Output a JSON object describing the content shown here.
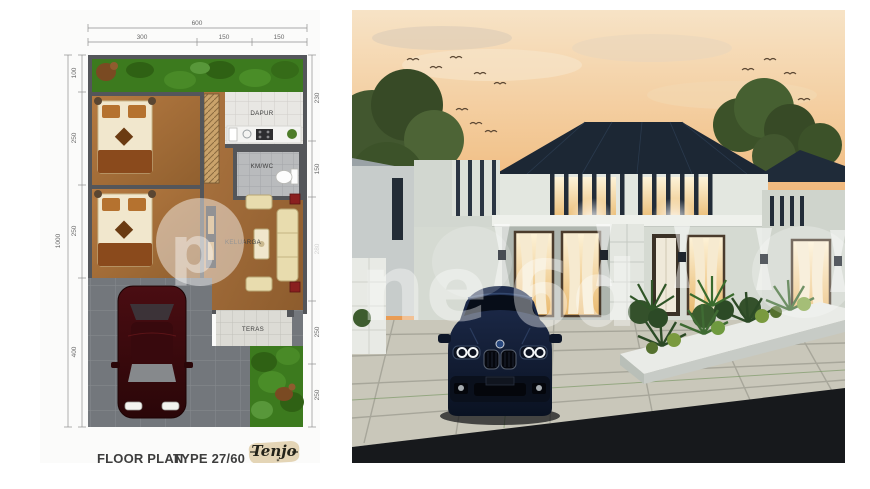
{
  "floor_plan": {
    "title": "FLOOR PLAN",
    "type_label": "TYPE 27/60",
    "logo": {
      "text": "Tenjo",
      "star": "✶"
    },
    "rooms": {
      "kitchen": "DAPUR",
      "bath": "KM/WC",
      "family": "KELUARGA",
      "terrace": "TERAS"
    },
    "dimensions": {
      "top_total": "600",
      "top_segments": [
        "300",
        "150",
        "150"
      ],
      "left_total": "1000",
      "left_segments": [
        "100",
        "250",
        "250",
        "400"
      ],
      "right_segments": [
        "230",
        "150",
        "280",
        "250",
        "250"
      ]
    },
    "colors": {
      "wall": "#54565a",
      "wood_floor": "#a8713e",
      "grass": "#3c7a1e",
      "kitchen_tile": "#e8e7e3",
      "bath_tile": "#b9bbbd",
      "carport": "#73777c",
      "car": "#3a0a0d"
    }
  },
  "render": {
    "watermark_fragments": {
      "left": "p",
      "mid": "ne",
      "right": "6d"
    },
    "colors": {
      "sky_top": "#f7e3c6",
      "sky_bottom": "#e89a52",
      "roof": "#1c2734",
      "wall": "#d5dad2",
      "window_glow": "#f6e3b8",
      "car": "#16233f",
      "road": "#17191c",
      "paver": "#c9c7ba",
      "foliage": "#3f5d2e"
    }
  }
}
